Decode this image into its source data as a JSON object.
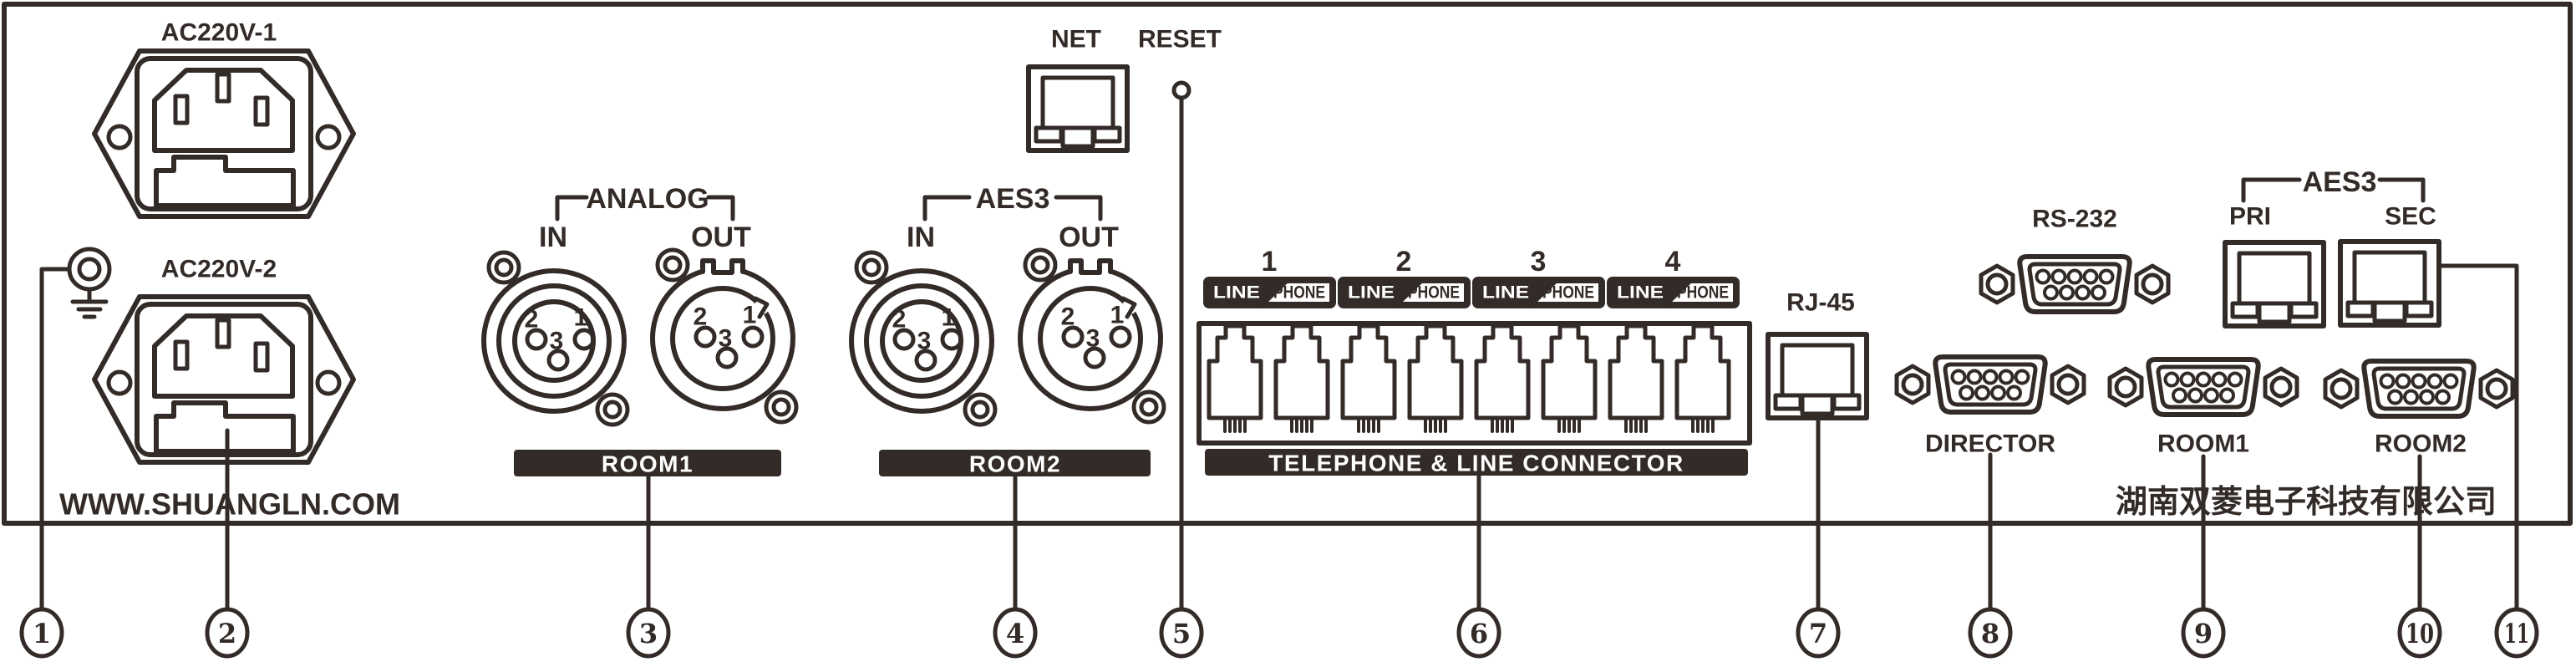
{
  "diagram": {
    "power": {
      "inlet1_label": "AC220V-1",
      "inlet2_label": "AC220V-2",
      "website": "WWW.SHUANGLN.COM"
    },
    "xlr_pins": {
      "p1": "1",
      "p2": "2",
      "p3": "3"
    },
    "analog": {
      "bracket_label": "ANALOG",
      "in_label": "IN",
      "out_label": "OUT",
      "room_label": "ROOM1"
    },
    "aes3_xlr": {
      "bracket_label": "AES3",
      "in_label": "IN",
      "out_label": "OUT",
      "room_label": "ROOM2"
    },
    "network": {
      "net_label": "NET",
      "reset_label": "RESET"
    },
    "phone": {
      "groups": [
        {
          "number": "1",
          "line_label": "LINE",
          "phone_label": "PHONE"
        },
        {
          "number": "2",
          "line_label": "LINE",
          "phone_label": "PHONE"
        },
        {
          "number": "3",
          "line_label": "LINE",
          "phone_label": "PHONE"
        },
        {
          "number": "4",
          "line_label": "LINE",
          "phone_label": "PHONE"
        }
      ],
      "bar_label": "TELEPHONE & LINE CONNECTOR"
    },
    "rj45_label": "RJ-45",
    "rs232_label": "RS-232",
    "director_label": "DIRECTOR",
    "aes3_net": {
      "bracket_label": "AES3",
      "pri_label": "PRI",
      "sec_label": "SEC"
    },
    "room1_db9_label": "ROOM1",
    "room2_db9_label": "ROOM2",
    "company_name": "湖南双菱电子科技有限公司",
    "callouts": [
      {
        "number": "1"
      },
      {
        "number": "2"
      },
      {
        "number": "3"
      },
      {
        "number": "4"
      },
      {
        "number": "5"
      },
      {
        "number": "6"
      },
      {
        "number": "7"
      },
      {
        "number": "8"
      },
      {
        "number": "9"
      },
      {
        "number": "10"
      },
      {
        "number": "11"
      }
    ]
  }
}
